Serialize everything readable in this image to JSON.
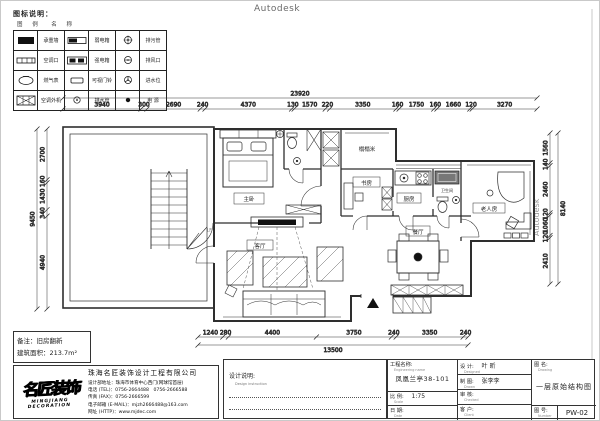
{
  "watermarks": {
    "top": "Autodesk",
    "bottom": "Autodesk",
    "right": "Autodesk"
  },
  "legend": {
    "title": "图标说明：",
    "headers": "图 例　名 称",
    "rows": [
      [
        {
          "icon": "bearing-wall",
          "name": "承重墙"
        },
        {
          "icon": "weak-box",
          "name": "弱电箱"
        },
        {
          "icon": "sewage-pipe",
          "name": "排污管"
        }
      ],
      [
        {
          "icon": "ac-vent",
          "name": "空调口"
        },
        {
          "icon": "strong-box",
          "name": "强电箱"
        },
        {
          "icon": "air-outlet",
          "name": "排风口"
        }
      ],
      [
        {
          "icon": "gas-meter",
          "name": "燃气表"
        },
        {
          "icon": "doorbell",
          "name": "可视门铃"
        },
        {
          "icon": "water-inlet",
          "name": "进水位"
        }
      ],
      [
        {
          "icon": "ac-outdoor",
          "name": "空调外机"
        },
        {
          "icon": "drain-pipe",
          "name": "排水管"
        },
        {
          "icon": "power",
          "name": "电 源"
        }
      ]
    ]
  },
  "plan": {
    "rooms": {
      "master": "主卧",
      "living": "客厅",
      "dining": "餐厅",
      "kitchen": "厨房",
      "study": "书房",
      "tatami": "榻榻米",
      "bathroom": "卫生间",
      "elder": "老人房",
      "floor_mark": "1F"
    },
    "dims": {
      "top": {
        "total": "23920",
        "segments": [
          "3940",
          "300",
          "2690",
          "240",
          "4370",
          "130",
          "1570",
          "220",
          "3350",
          "160",
          "1750",
          "160",
          "1660",
          "120",
          "3270"
        ]
      },
      "bottom": {
        "total": "13500",
        "segments": [
          "1240",
          "280",
          "4400",
          "3750",
          "240",
          "3350",
          "240"
        ]
      },
      "left": {
        "total": "9450",
        "segments": [
          "2700",
          "160",
          "1430",
          "340",
          "4940"
        ]
      },
      "right": {
        "total": "8140",
        "segments": [
          "1560",
          "140",
          "2460",
          "120",
          "1060",
          "120",
          "2410"
        ]
      }
    }
  },
  "notes": {
    "line1": "备注：旧房翻新",
    "line2": "建筑面积：213.7m²"
  },
  "company": {
    "logo": "名匠装饰",
    "logo_sub": "MINGJIANG DECORATION",
    "name": "珠海名匠装饰设计工程有限公司",
    "address": "设计部地址：珠海市体育中心西门(网球馆首层)",
    "tel": "电话 (TEL)：0756-2664488　0756-2666588",
    "fax": "传真 (FAX)：0756-2666599",
    "email": "电子邮箱 (E-MAIL)：mjzh2666488@163.com",
    "web": "网址 (HTTP)：www.mjdec.com"
  },
  "design_notes": {
    "label": "设计说明:",
    "eng": "Design instruction"
  },
  "titleblock": {
    "project_label": "工程名称:",
    "project_eng": "Engineering name",
    "project_value": "凤凰兰亭38-101",
    "scale_label": "比 例:",
    "scale_eng": "Scale",
    "scale_value": "1:75",
    "date_label": "日 期:",
    "date_eng": "Date",
    "date_value": "",
    "designer_label": "设 计:",
    "designer_eng": "Designed",
    "designer_value": "叶 昕",
    "drafter_label": "制 图:",
    "drafter_eng": "Drawn",
    "drafter_value": "张李李",
    "checker_label": "审 核:",
    "checker_eng": "Checked",
    "checker_value": "",
    "client_label": "客 户:",
    "client_eng": "Client",
    "client_value": "",
    "drawing_label": "图 名:",
    "drawing_eng": "Drawing",
    "drawing_value": "一层原始结构图",
    "number_label": "图 号:",
    "number_eng": "Number",
    "number_value": "PW-02"
  }
}
